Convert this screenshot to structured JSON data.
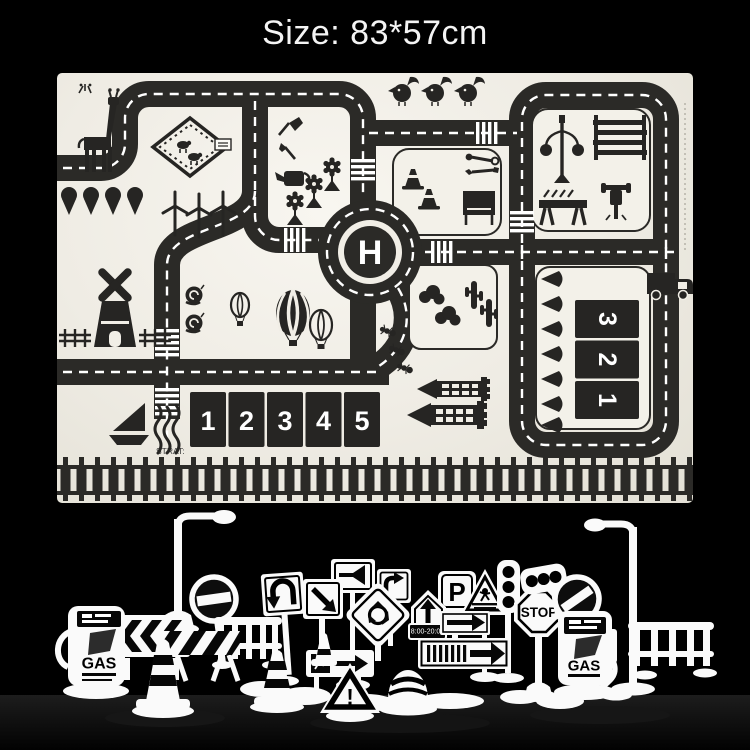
{
  "title": "Size: 83*57cm",
  "colors": {
    "background": "#000000",
    "mat_background": "#efece4",
    "road": "#2b2a27",
    "marking": "#ffffff",
    "toy_color": "#fafafa"
  },
  "mat": {
    "helipad_label": "H",
    "start_label": "STRAT:",
    "parking_row": [
      "1",
      "2",
      "3",
      "4",
      "5"
    ],
    "parking_side": [
      "3",
      "2",
      "1"
    ],
    "icons": [
      "giraffe",
      "paddock-fence",
      "row-trees",
      "wind-turbines",
      "garden-tools",
      "flowers",
      "birds",
      "traffic-cones",
      "wrench-pliers",
      "billboard",
      "street-lamp",
      "scaffold-ladder",
      "work-barricade",
      "jackhammer",
      "windmill",
      "snails",
      "hot-air-balloons",
      "sailboat",
      "waves",
      "bushes",
      "cacti",
      "ants",
      "castle-towers",
      "pin-trees",
      "truck",
      "roundabout-helipad",
      "zebra-crossings",
      "railroad-track"
    ]
  },
  "toys": {
    "labels": {
      "gas_left": "GAS",
      "gas_right": "GAS",
      "stop": "STOP",
      "parking": "P",
      "time_plate": "8:00-20:00",
      "warning": "!"
    },
    "items": [
      "street-lamp-left",
      "gas-pump-left",
      "chevron-barrier",
      "no-entry-sign",
      "striped-barricade",
      "rail-fence-left",
      "traffic-cone-large",
      "traffic-cone-right",
      "u-turn-sign",
      "diagonal-arrow-sign",
      "horn-sign",
      "right-turn-sign",
      "roundabout-sign",
      "ahead-only-sign",
      "parking-sign",
      "time-plate",
      "direction-arrow-plate",
      "pedestrian-crossing-sign",
      "traffic-light-vertical",
      "lane-arrow-board",
      "falling-rocks-sign",
      "warning-triangle",
      "striped-dome",
      "small-cone",
      "stop-sign",
      "traffic-light-horizontal",
      "no-entry-slash-sign",
      "gas-pump-right",
      "street-lamp-right",
      "rail-fence-right"
    ]
  }
}
